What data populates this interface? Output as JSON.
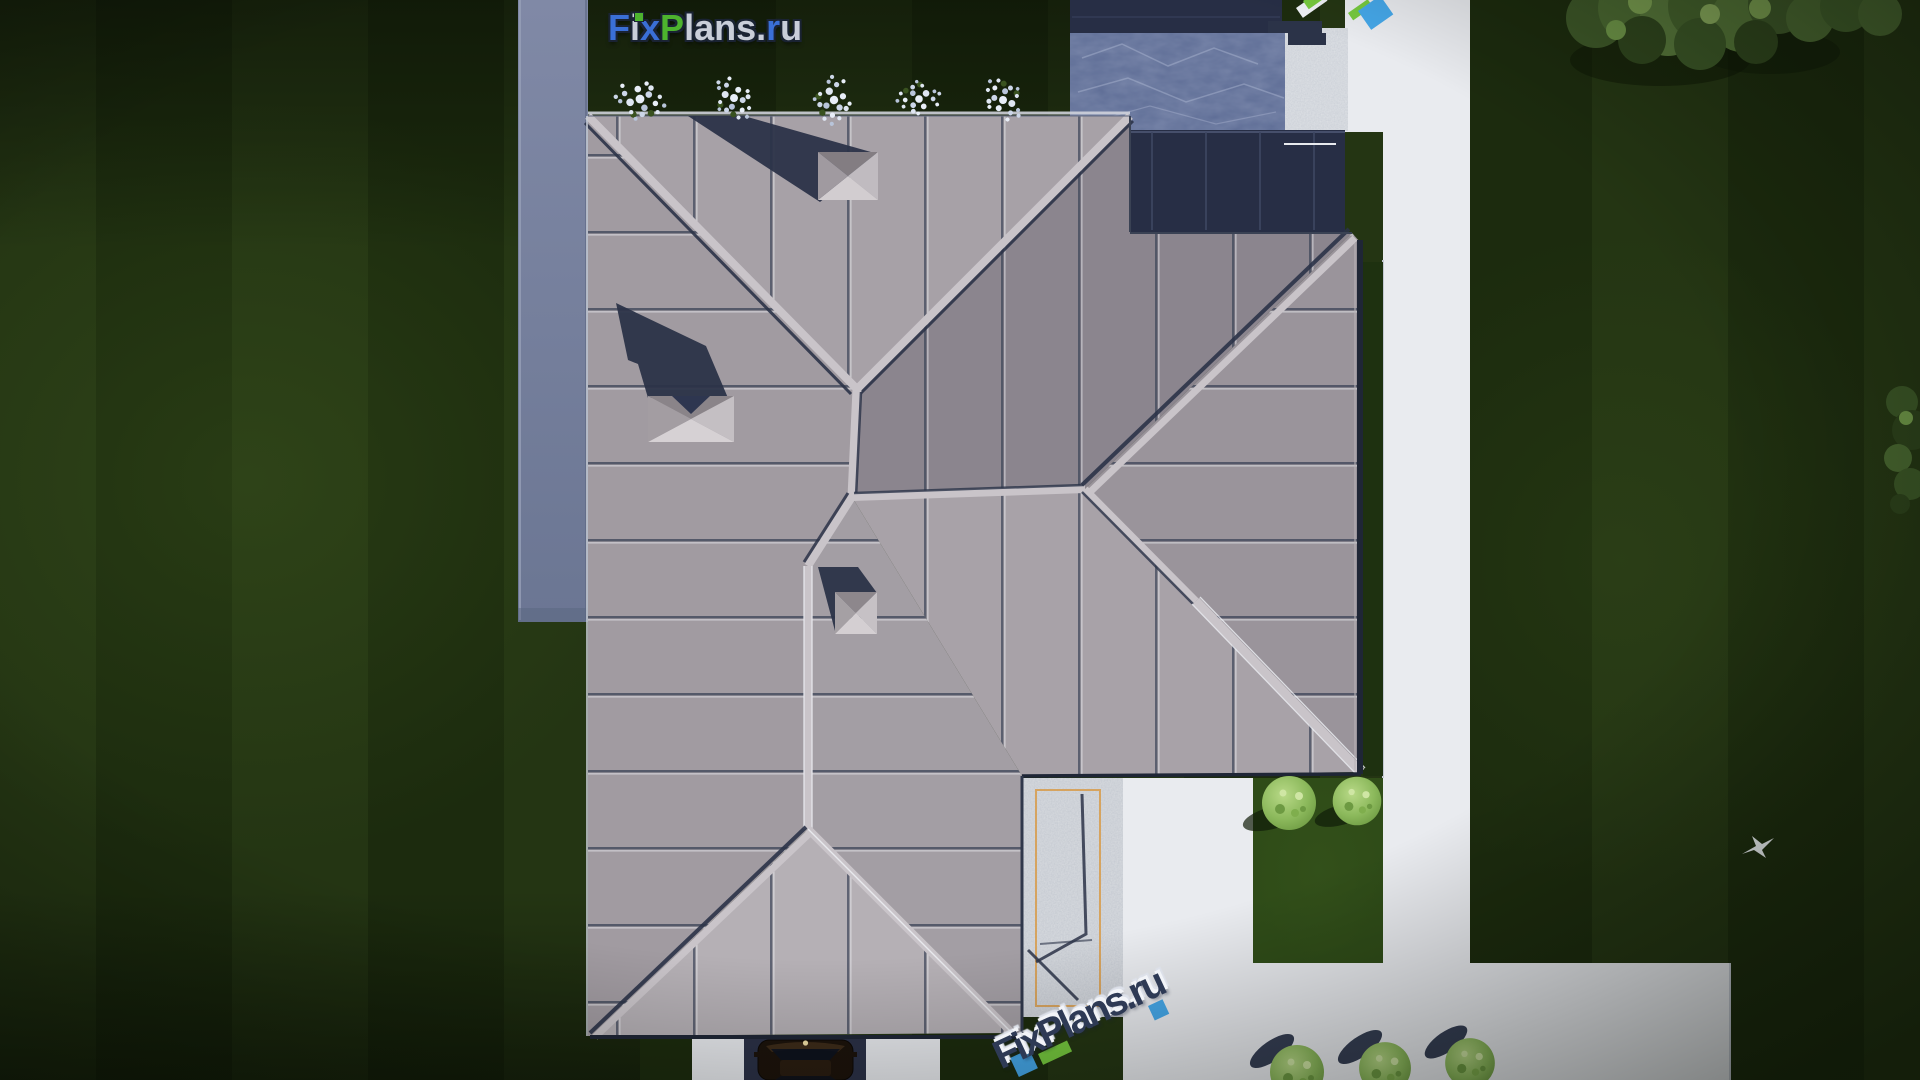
{
  "watermarks": {
    "logo_top": {
      "text": "FixPlans.ru",
      "letters": [
        {
          "ch": "F",
          "style": "color:#3a6fd6"
        },
        {
          "ch": "i",
          "style": "color:#c9ced9"
        },
        {
          "ch": "x",
          "style": "color:#3a6fd6"
        },
        {
          "ch": "P",
          "style": "color:#4db32e"
        },
        {
          "ch": "l",
          "style": "color:#c9ced9"
        },
        {
          "ch": "a",
          "style": "color:#c9ced9"
        },
        {
          "ch": "n",
          "style": "color:#c9ced9"
        },
        {
          "ch": "s",
          "style": "color:#c9ced9"
        },
        {
          "ch": ".",
          "style": "color:#c9ced9"
        },
        {
          "ch": "r",
          "style": "color:#3a6fd6"
        },
        {
          "ch": "u",
          "style": "color:#c9ced9"
        }
      ]
    },
    "logo_bottom": {
      "text": "FixPlans.ru"
    },
    "logo_corner": {
      "text": "FixPlans.ru"
    }
  },
  "scene": {
    "chimney_count": 3,
    "flower_cluster_count": 5,
    "lawn_bush_count": 2,
    "bottom_bush_count": 3,
    "car_count": 1,
    "bird_count": 1
  },
  "colors": {
    "grass_stripe_light": "#243513",
    "grass_stripe_dark": "#1c2b0e",
    "hedge": "#1e3110",
    "lawn_patch": "#2f4c18",
    "roof_west": "#a19ba1",
    "roof_north": "#a7a1a7",
    "roof_east": "#8b858e",
    "roof_wing_east": "#9a949b",
    "roof_wing_south": "#a8a2a8",
    "roof_southeast": "#a39ea4",
    "roof_triangle": "#b5b0b5",
    "ridge": "#c9c4c9",
    "seam_dark": "#3b4357",
    "seam_light": "#eef0f4",
    "shadow_navy": "#2b3348",
    "flat_roof_navy": "#272e45",
    "left_path": "#76819f",
    "white_path": "#e9ebef",
    "gravel": "#d9dce0",
    "marble_terrace": "#5d6c95",
    "concrete": "#dfe2e6",
    "pergola_trim_orange": "#d79b4a",
    "driveway": "#2b3147",
    "car_body": "#1c130b",
    "flowers": "#dfe6f2",
    "bush": "#9cc368",
    "tree_dark": "#33491f",
    "logo_blue": "#3a6fd6",
    "logo_green": "#4db32e",
    "logo_gray": "#c9ced9",
    "logo_outline": "#1a2333",
    "wm_navy": "#2e3a55",
    "wm_green": "#76c93e",
    "wm_blue": "#45a7e8"
  }
}
